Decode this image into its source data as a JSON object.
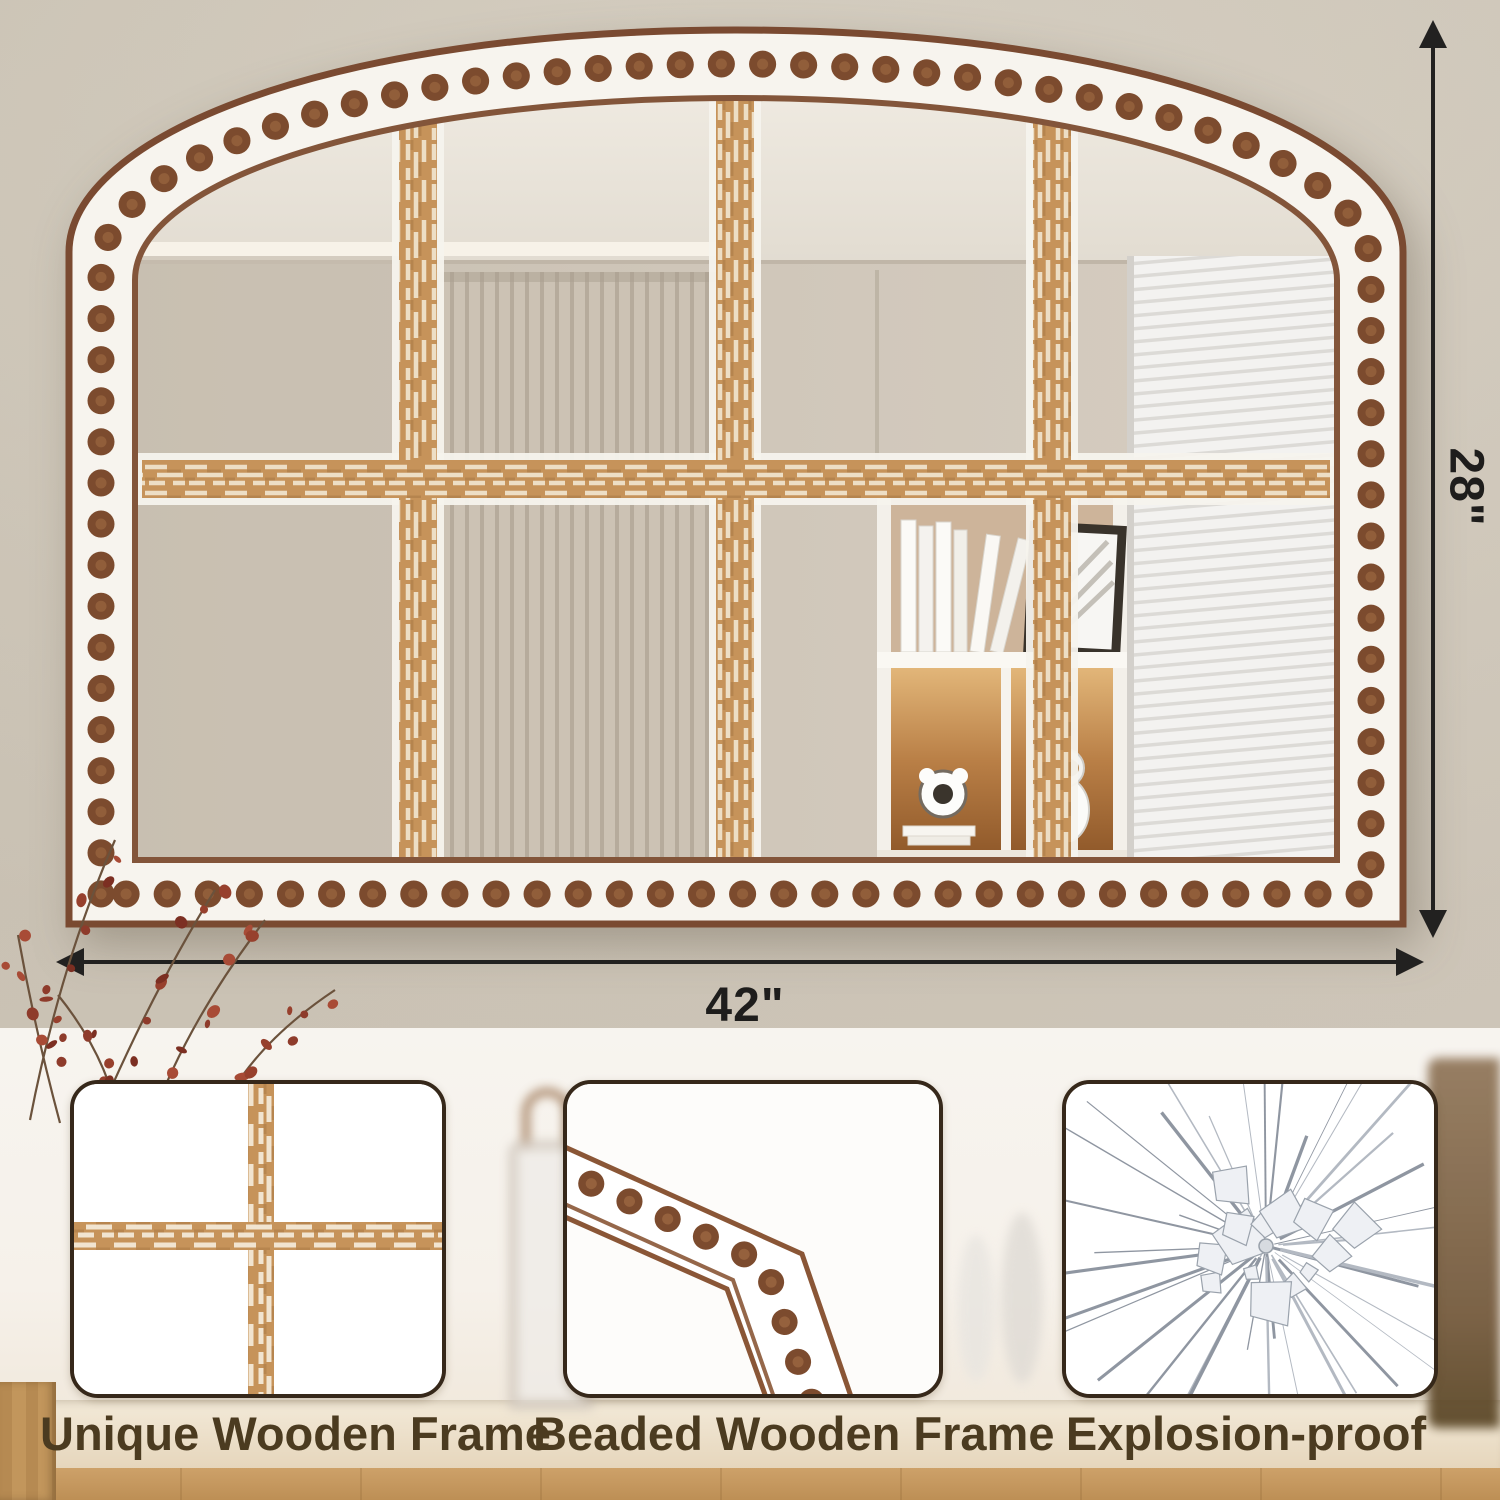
{
  "product_annotation": {
    "height_label": "28\"",
    "width_label": "42\""
  },
  "features": [
    {
      "label": "Unique Wooden Frame",
      "icon": "wood-cross-graphic"
    },
    {
      "label": "Beaded Wooden Frame",
      "icon": "beaded-corner-graphic"
    },
    {
      "label": "Explosion-proof",
      "icon": "shattered-glass-graphic"
    }
  ],
  "colors": {
    "wall": "#d1c9bb",
    "frame_white": "#f7f4ee",
    "bead_brown": "#7c4b2e",
    "trim_brown": "#7a4a31",
    "rustic_wood": "#c6935a",
    "dimension_line": "#222120",
    "label_text": "#4b3b20",
    "card_border": "#36281a"
  }
}
